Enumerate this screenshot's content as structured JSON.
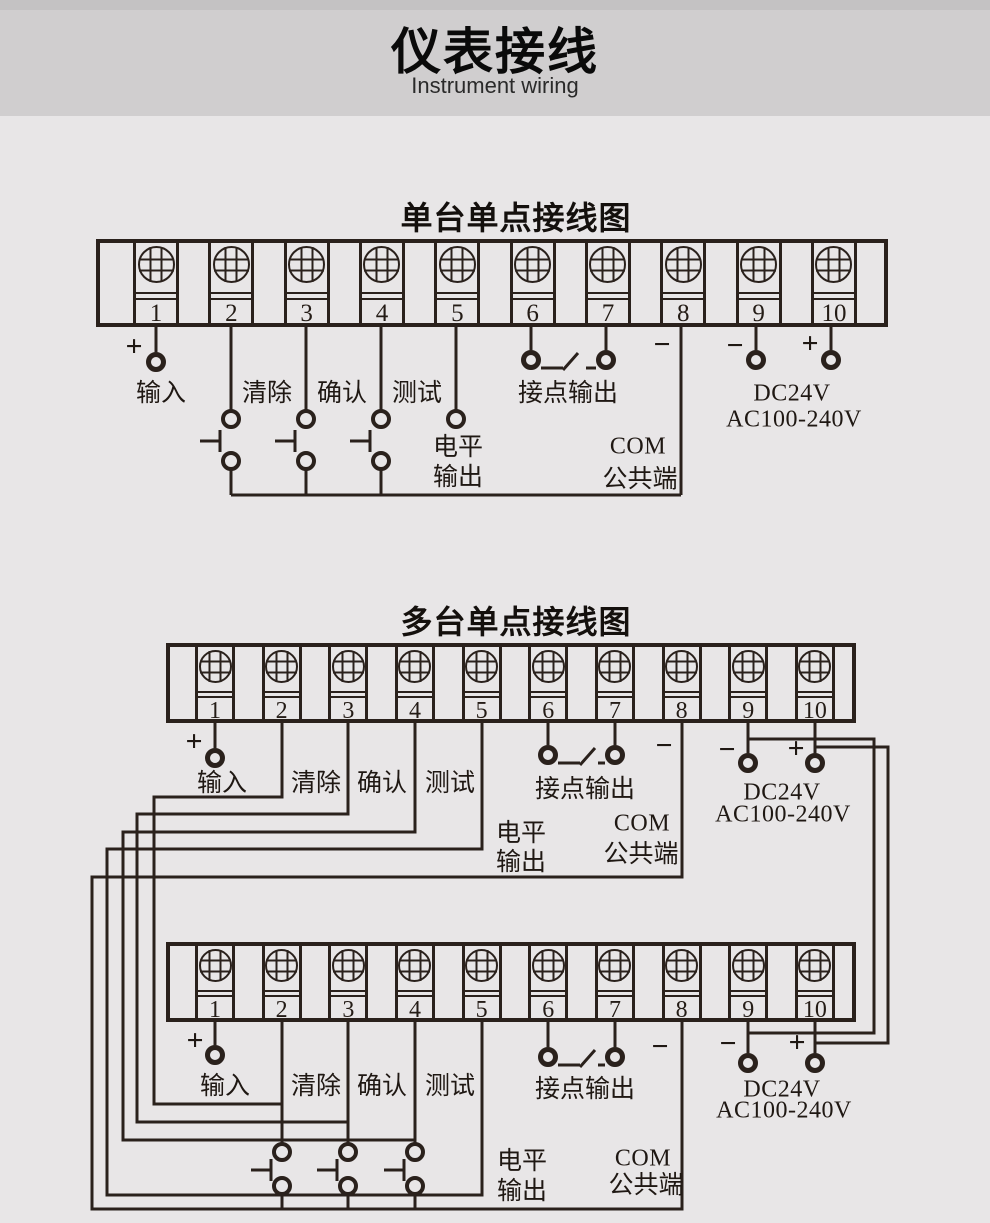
{
  "header": {
    "title": "仪表接线",
    "subtitle": "Instrument wiring"
  },
  "sections": {
    "single": {
      "title": "单台单点接线图"
    },
    "multi": {
      "title": "多台单点接线图"
    }
  },
  "terminals": [
    "1",
    "2",
    "3",
    "4",
    "5",
    "6",
    "7",
    "8",
    "9",
    "10"
  ],
  "labels": {
    "input": "输入",
    "clear": "清除",
    "confirm": "确认",
    "test": "测试",
    "contact_output": "接点输出",
    "level_1": "电平",
    "level_2": "输出",
    "com": "COM",
    "com_2": "公共端",
    "power_dc": "DC24V",
    "power_ac": "AC100-240V",
    "plus": "+",
    "minus": "−"
  },
  "colors": {
    "header_bg": "#d0cecf",
    "header_top_strip": "#c4c2c3",
    "body_bg": "#e8e6e7",
    "line": "#2a211c",
    "text": "#1f1813"
  }
}
